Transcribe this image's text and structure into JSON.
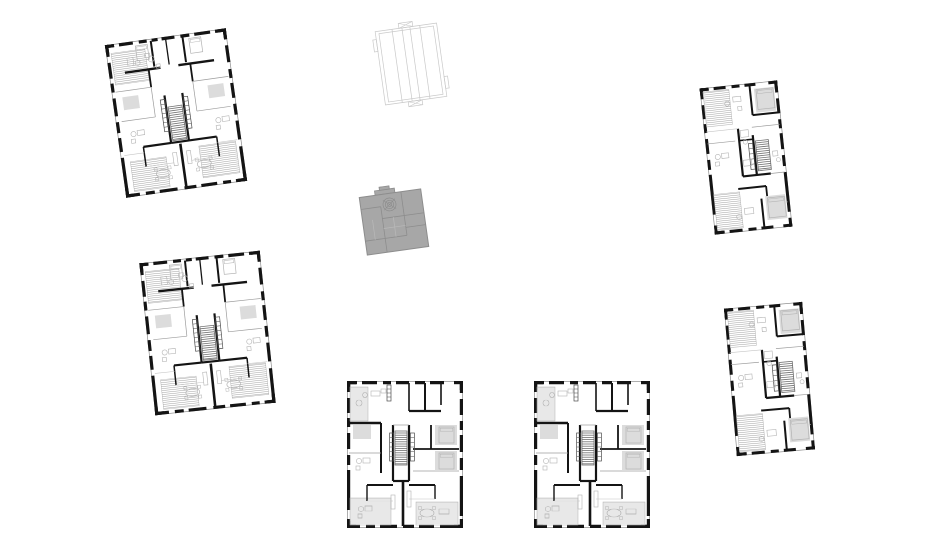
{
  "page": {
    "kind": "architectural-site-sheet",
    "description": "white sheet with six detailed apartment floor plans, one gray building mass and one light roof outline",
    "canvas": {
      "width": 940,
      "height": 546
    }
  },
  "palette": {
    "background": "#ffffff",
    "wall": "#141414",
    "partition": "#9c9c9c",
    "light_line": "#c6c6c6",
    "furniture": "#b3b3b3",
    "hatch": "#9a9a9a",
    "outline": "#8c8c8c",
    "soft_fill": "#dcdcdc",
    "stair": "#6f6f6f",
    "closet": "#4a4a4a",
    "mass_fill": "#a7a7a7",
    "mass_line": "#8d8d8d",
    "mass_line_light": "#b9b9b9",
    "roof_line": "#c9c9c9"
  },
  "plans": [
    {
      "id": "floor-plan-north-west",
      "type": "large",
      "cx": 176,
      "cy": 113,
      "w": 122,
      "h": 154,
      "rotation": -8
    },
    {
      "id": "floor-plan-west",
      "type": "large",
      "cx": 207,
      "cy": 333,
      "w": 121,
      "h": 154,
      "rotation": -6
    },
    {
      "id": "roof-outline",
      "type": "roof",
      "cx": 411,
      "cy": 64,
      "w": 62,
      "h": 74,
      "rotation": -8
    },
    {
      "id": "gray-building-mass",
      "type": "mass",
      "cx": 394,
      "cy": 222,
      "w": 62,
      "h": 58,
      "rotation": -8
    },
    {
      "id": "floor-plan-south-left",
      "type": "medium",
      "cx": 405,
      "cy": 454,
      "w": 116,
      "h": 147,
      "rotation": 0
    },
    {
      "id": "floor-plan-south-right",
      "type": "medium",
      "cx": 592,
      "cy": 454,
      "w": 116,
      "h": 147,
      "rotation": 0
    },
    {
      "id": "floor-plan-east-top",
      "type": "small",
      "cx": 746,
      "cy": 157,
      "w": 78,
      "h": 147,
      "rotation": -6
    },
    {
      "id": "floor-plan-east-bottom",
      "type": "small",
      "cx": 769,
      "cy": 379,
      "w": 79,
      "h": 148,
      "rotation": -5
    }
  ]
}
